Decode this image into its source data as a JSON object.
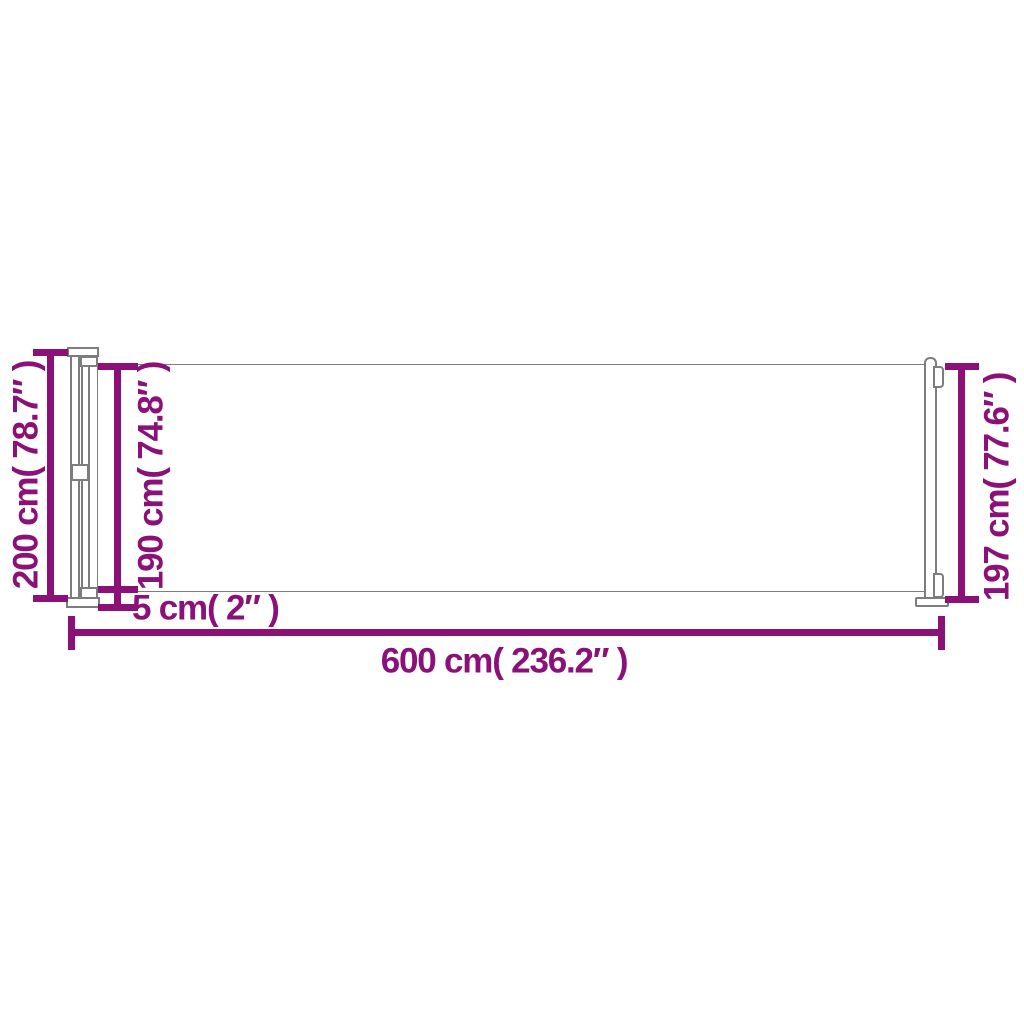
{
  "colors": {
    "accent": "#8B1179",
    "outline": "#7D7D7D",
    "background": "#FFFFFF"
  },
  "dimensions": {
    "total_height_left": "200 cm( 78.7″ )",
    "fabric_height": "190 cm( 74.8″ )",
    "ground_clearance": "5 cm( 2″ )",
    "total_width": "600 cm( 236.2″ )",
    "pole_height_right": "197 cm( 77.6″ )"
  }
}
